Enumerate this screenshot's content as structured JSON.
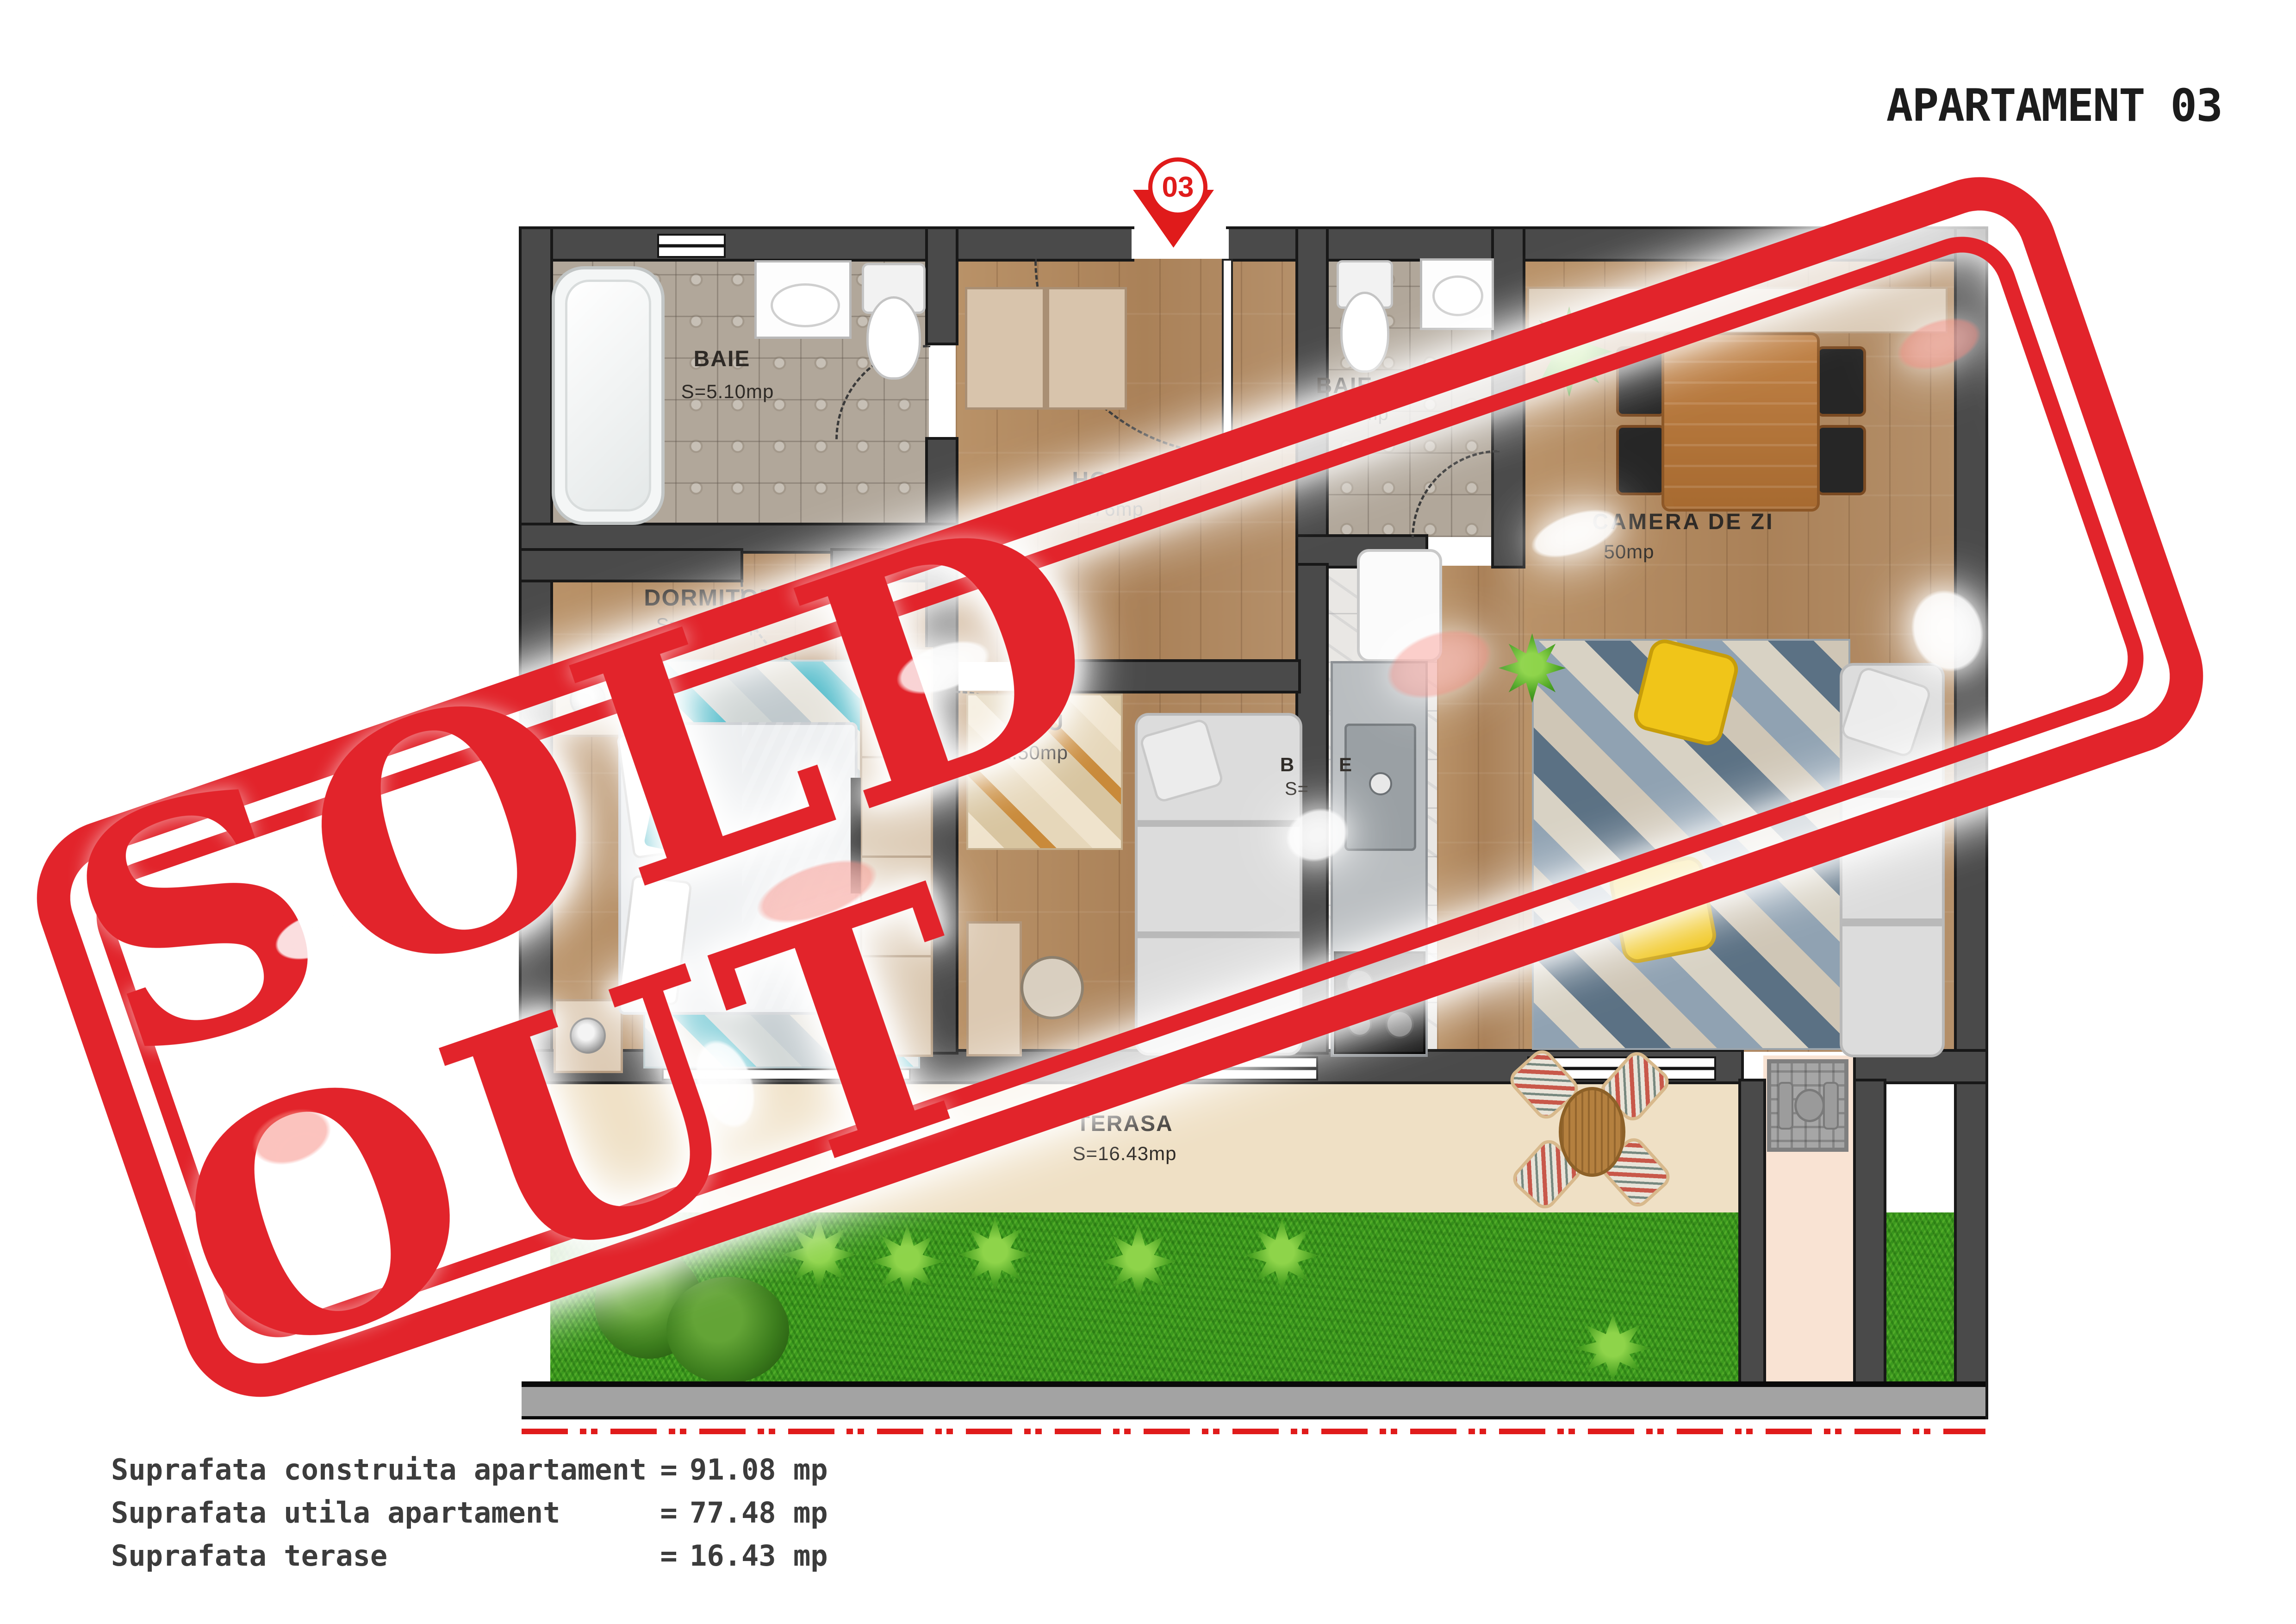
{
  "title": "APARTAMENT 03",
  "entrance_marker": "03",
  "stamp": {
    "text": "SOLD OUT",
    "color": "#e2242b"
  },
  "rooms": {
    "baie1": {
      "name": "BAIE",
      "area": "S=5.10mp"
    },
    "hol": {
      "name": "HOL",
      "area": "S=11.76mp"
    },
    "baie2": {
      "name": "BAIE",
      "area": "S=2.56mp"
    },
    "dormitor": {
      "name": "DORMITOR",
      "area": "S=14.85mp"
    },
    "camera_de_zi": {
      "name": "CAMERA DE ZI",
      "area_visible_fragment": "50mp"
    },
    "birou": {
      "name_visible_fragment": "IRU",
      "area_visible_fragment": "1.50mp"
    },
    "bucatarie": {
      "name_fragment_1": "B",
      "name_fragment_2": "E",
      "area_fragment": "S="
    },
    "terasa": {
      "name": "TERASA",
      "area": "S=16.43mp"
    }
  },
  "legend": {
    "rows": [
      {
        "label": "Suprafata construita apartament",
        "eq": "=",
        "value": "91.08 mp"
      },
      {
        "label": "Suprafata utila apartament",
        "eq": "=",
        "value": "77.48 mp"
      },
      {
        "label": "Suprafata terase",
        "eq": "=",
        "value": "16.43 mp"
      }
    ]
  },
  "colors": {
    "stamp_red": "#e2242b",
    "marker_red": "#e01b1b",
    "wall_gray": "#4a4a4a",
    "wall_outline": "#181818",
    "wood_floor": "#b18a62",
    "tile_floor": "#b1a79a",
    "deck_floor": "#efe0c5",
    "grass_green": "#3c9a1e",
    "utility_cream": "#f9e3d3",
    "label_ink": "#2e2a26",
    "legend_ink": "#3c3c3c"
  }
}
